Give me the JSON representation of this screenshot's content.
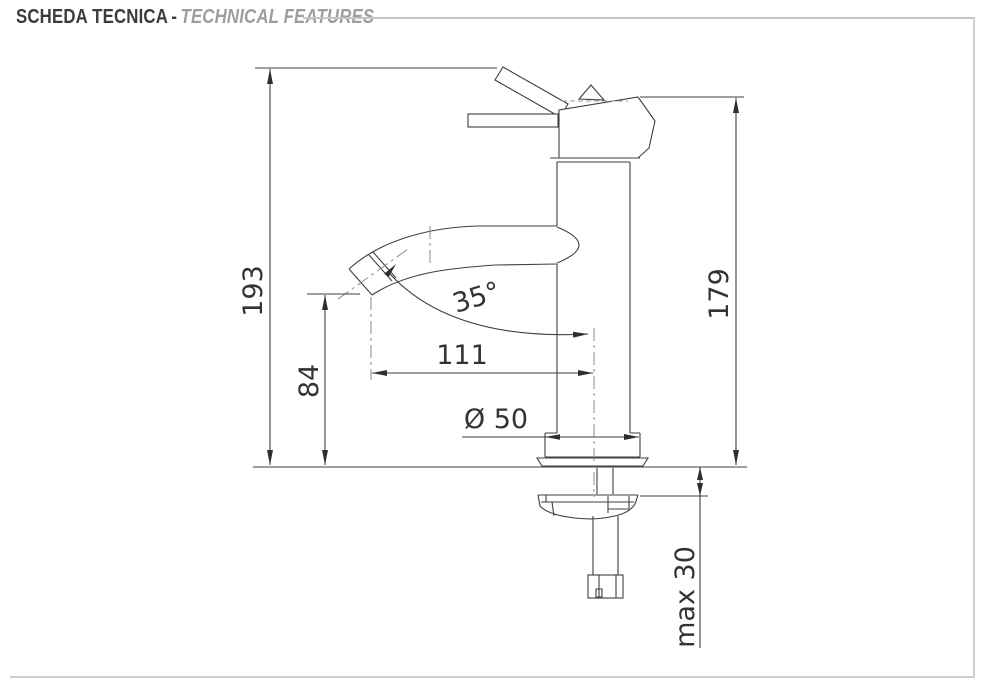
{
  "header": {
    "title_primary": "SCHEDA TECNICA",
    "title_separator": "-",
    "title_secondary": "TECHNICAL FEATURES"
  },
  "drawing": {
    "subject": "single-lever-basin-mixer-tap-side-elevation",
    "dimensions": {
      "overall_height": {
        "label": "193",
        "meaning": "overall height to lever tip"
      },
      "body_height": {
        "label": "179",
        "meaning": "height of body top edge"
      },
      "spout_height": {
        "label": "84",
        "meaning": "spout outlet height above counter"
      },
      "spout_reach": {
        "label": "111",
        "meaning": "outlet centre to body centreline"
      },
      "spout_angle": {
        "label": "35°",
        "meaning": "spout outlet angle"
      },
      "base_diameter": {
        "label": "Ø 50",
        "meaning": "base flange diameter"
      },
      "max_mount_thickness": {
        "label": "max 30",
        "meaning": "maximum counter thickness"
      }
    },
    "colors": {
      "outline": "#3f3f3f",
      "centerline": "#8a8a8a",
      "dimension_text": "#333333",
      "frame": "#cdd0d2",
      "title_primary": "#3c3c3e",
      "title_secondary": "#9b9da0"
    }
  }
}
